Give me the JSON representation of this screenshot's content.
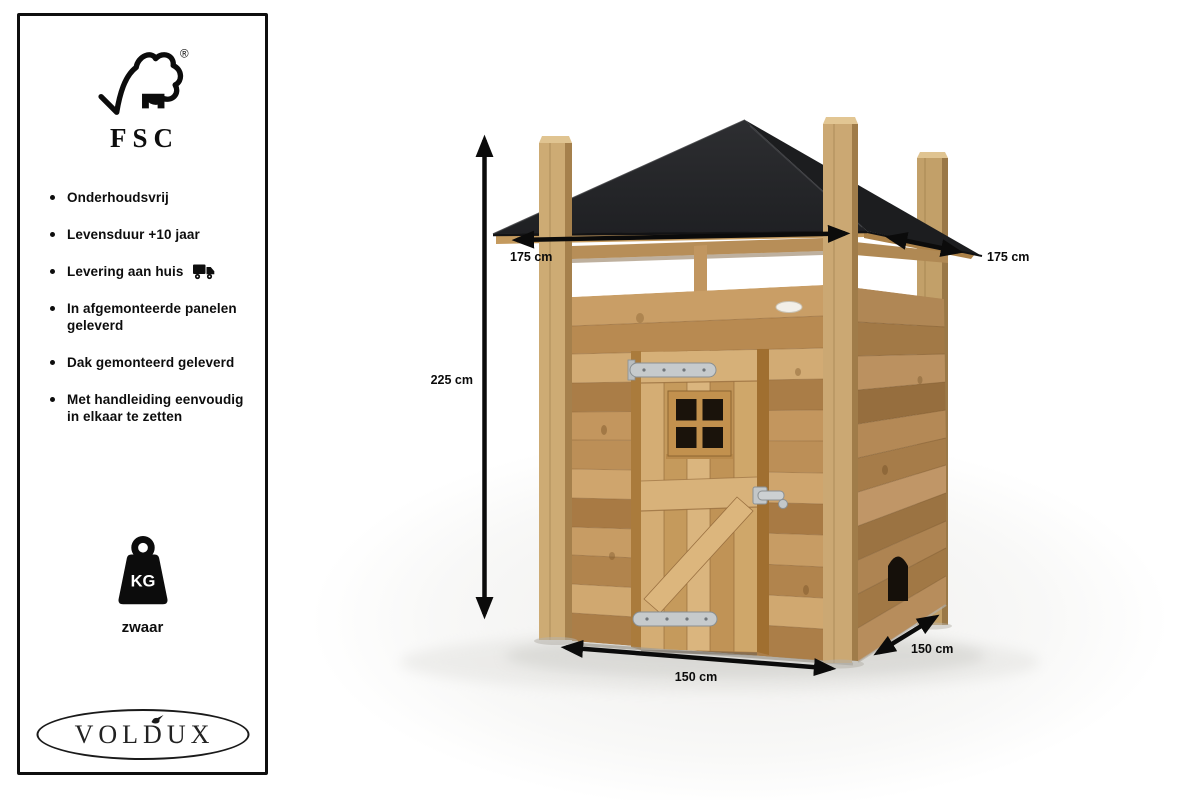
{
  "sidebar": {
    "fsc_label": "FSC",
    "registered_mark": "®",
    "features": [
      "Onderhoudsvrij",
      "Levensduur +10 jaar",
      "Levering aan huis",
      "In afgemonteerde panelen geleverd",
      "Dak gemonteerd geleverd",
      "Met handleiding eenvoudig in elkaar te zetten"
    ],
    "weight": {
      "unit_label": "KG",
      "label": "zwaar"
    },
    "brand": "VOLDUX"
  },
  "product": {
    "dimensions": {
      "height": "225 cm",
      "roof_width": "175 cm",
      "roof_depth": "175 cm",
      "base_width": "150 cm",
      "base_depth": "150 cm"
    }
  },
  "colors": {
    "roof_black": "#222326",
    "wood_main": "#c49760",
    "arrow_black": "#0b0b0b"
  }
}
